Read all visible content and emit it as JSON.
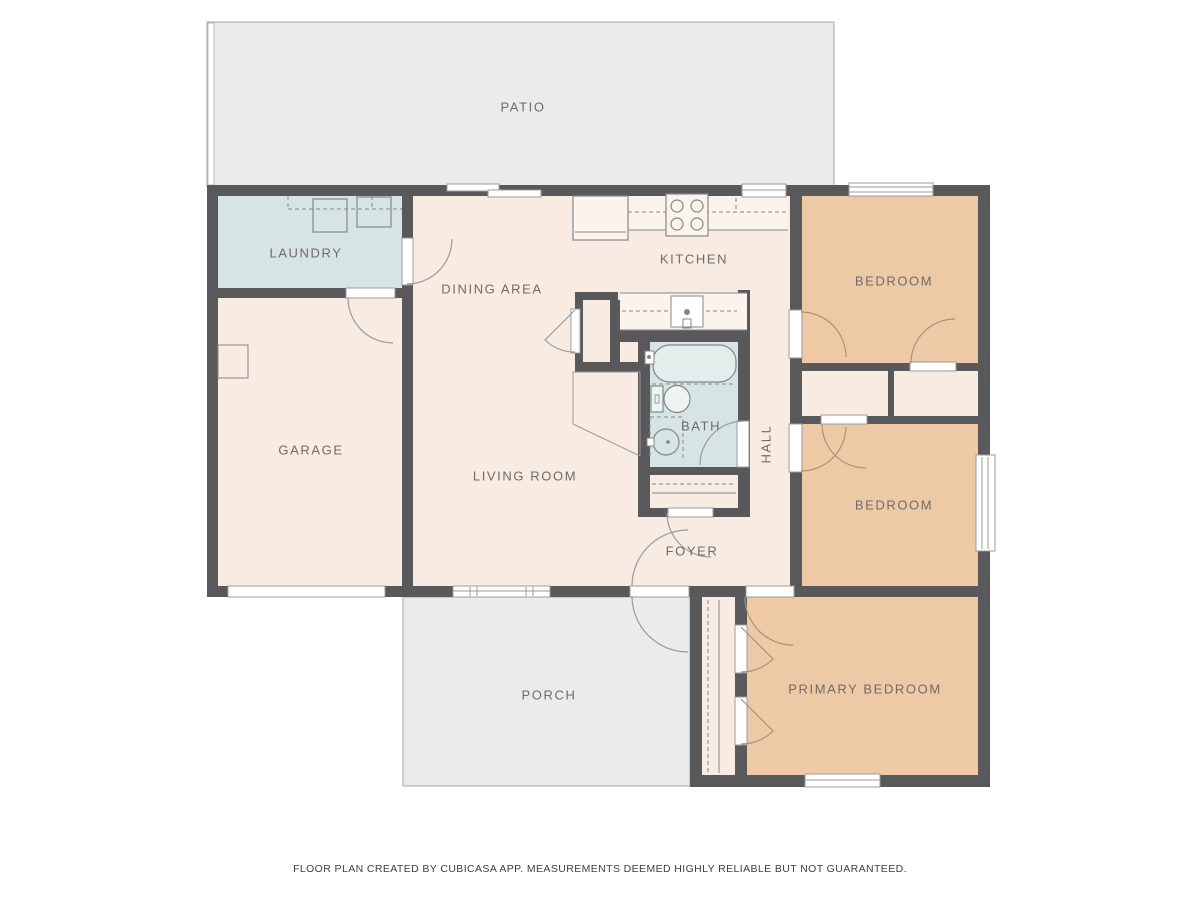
{
  "rooms": {
    "patio": {
      "label": "PATIO"
    },
    "laundry": {
      "label": "LAUNDRY"
    },
    "dining": {
      "label": "DINING AREA"
    },
    "kitchen": {
      "label": "KITCHEN"
    },
    "bedroom_top": {
      "label": "BEDROOM"
    },
    "garage": {
      "label": "GARAGE"
    },
    "living": {
      "label": "LIVING ROOM"
    },
    "bath": {
      "label": "BATH"
    },
    "hall": {
      "label": "HALL"
    },
    "bedroom_mid": {
      "label": "BEDROOM"
    },
    "foyer": {
      "label": "FOYER"
    },
    "primary": {
      "label": "PRIMARY BEDROOM"
    },
    "porch": {
      "label": "PORCH"
    }
  },
  "footer": {
    "disclaimer": "FLOOR PLAN CREATED BY CUBICASA APP. MEASUREMENTS DEEMED HIGHLY RELIABLE BUT NOT GUARANTEED."
  },
  "colors": {
    "bg": "#ffffff",
    "wall": "#59595b",
    "floor": "#f8ebe2",
    "bedroom": "#eec9a6",
    "wet": "#d6e5e4",
    "outdoor": "#ebebed",
    "outdoor_border": "#a9a9ab",
    "counter": "#fbf4ed",
    "tub": "#e3edeb",
    "line": "#85868a",
    "arc": "#9a9a9c",
    "arc_warm": "#b28e74",
    "leaf_stroke": "#9b9b9b",
    "label": "#6f6b67",
    "footer": "#3f3f3f"
  }
}
